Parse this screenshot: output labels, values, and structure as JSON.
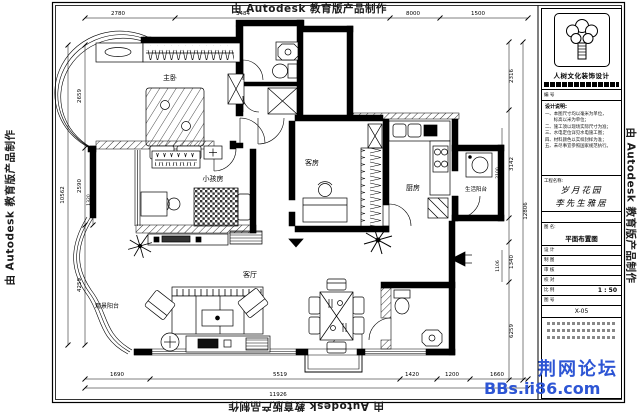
{
  "sheet": {
    "watermark": "由 Autodesk 教育版产品制作",
    "forum_name": "荆网论坛",
    "forum_url": "BBs.ii86.com"
  },
  "rooms": {
    "master": "主卧",
    "kids": "小孩房",
    "guest": "客房",
    "kitchen": "厨房",
    "service_balcony": "生活阳台",
    "living": "客厅",
    "view_balcony": "观景阳台"
  },
  "dims": {
    "top": [
      "2780",
      "3484",
      "8000",
      "1500"
    ],
    "left": [
      "2659",
      "2590",
      "1320",
      "4259"
    ],
    "left_total": "10562",
    "right": [
      "2316",
      "3142",
      "2100",
      "1106",
      "1340",
      "6259"
    ],
    "right_total": "12806",
    "bottom": [
      "1690",
      "5519",
      "1420",
      "1200",
      "1660"
    ],
    "bottom_total": "11926"
  },
  "title_block": {
    "company": "人树文化装饰设计",
    "code_row": "编 号",
    "notes_title": "设计说明:",
    "notes": [
      "一、本图尺寸均以毫米为单位，",
      "　　标高以米为单位；",
      "二、施工须以现场实际尺寸为准；",
      "三、水电定位详见水电施工图；",
      "四、材料颜色以实样封样为准；",
      "五、未尽事宜参照国家规范执行。"
    ],
    "project_label": "工程名称:",
    "project_name_1": "岁月花园",
    "project_name_2": "李先生雅居",
    "drawing_label": "图 名:",
    "drawing_name": "平面布置图",
    "rows": [
      {
        "label": "设 计"
      },
      {
        "label": "制 图"
      },
      {
        "label": "审 核"
      },
      {
        "label": "校 对"
      }
    ],
    "scale_label": "比 例",
    "scale_value": "1 : 50",
    "no_label": "图 号",
    "drawing_no": "X-05"
  }
}
